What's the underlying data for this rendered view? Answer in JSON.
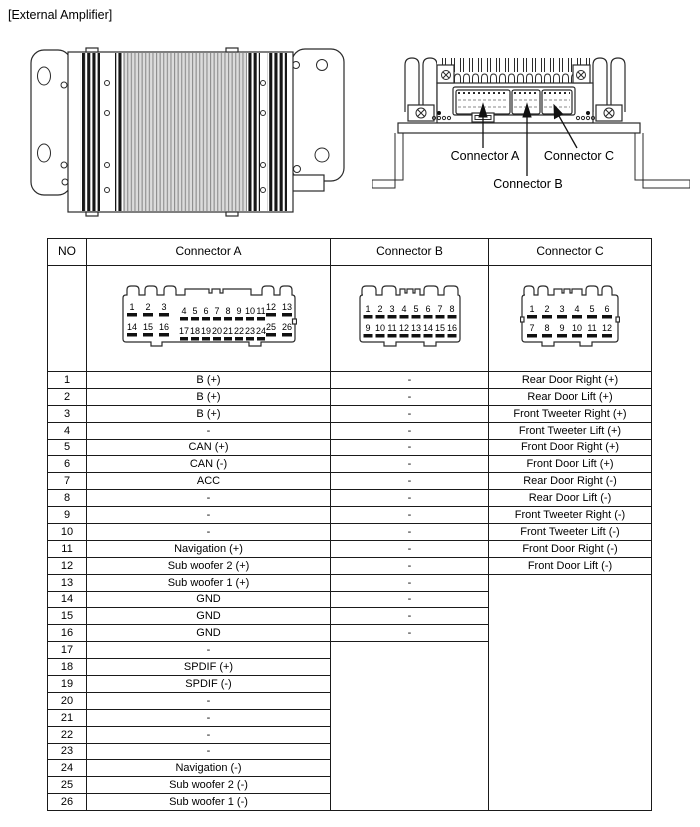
{
  "page": {
    "title": "[External Amplifier]"
  },
  "figures": {
    "rear_view": {
      "labels": {
        "connector_a": "Connector A",
        "connector_b": "Connector B",
        "connector_c": "Connector C"
      }
    }
  },
  "table": {
    "headers": [
      "NO",
      "Connector A",
      "Connector B",
      "Connector C"
    ],
    "pin_diagrams": {
      "a": {
        "top_left": [
          "1",
          "2",
          "3"
        ],
        "top_mid": [
          "4",
          "5",
          "6",
          "7",
          "8",
          "9",
          "10",
          "11"
        ],
        "top_right": [
          "12",
          "13"
        ],
        "bot_left": [
          "14",
          "15",
          "16"
        ],
        "bot_mid": [
          "17",
          "18",
          "19",
          "20",
          "21",
          "22",
          "23",
          "24"
        ],
        "bot_right": [
          "25",
          "26"
        ]
      },
      "b": {
        "top": [
          "1",
          "2",
          "3",
          "4",
          "5",
          "6",
          "7",
          "8"
        ],
        "bot": [
          "9",
          "10",
          "11",
          "12",
          "13",
          "14",
          "15",
          "16"
        ]
      },
      "c": {
        "top": [
          "1",
          "2",
          "3",
          "4",
          "5",
          "6"
        ],
        "bot": [
          "7",
          "8",
          "9",
          "10",
          "11",
          "12"
        ]
      }
    },
    "rows": [
      [
        "1",
        "B (+)",
        "-",
        "Rear Door Right (+)"
      ],
      [
        "2",
        "B (+)",
        "-",
        "Rear Door Lift (+)"
      ],
      [
        "3",
        "B (+)",
        "-",
        "Front Tweeter Right (+)"
      ],
      [
        "4",
        "-",
        "-",
        "Front Tweeter Lift (+)"
      ],
      [
        "5",
        "CAN (+)",
        "-",
        "Front Door Right (+)"
      ],
      [
        "6",
        "CAN (-)",
        "-",
        "Front Door Lift (+)"
      ],
      [
        "7",
        "ACC",
        "-",
        "Rear Door Right (-)"
      ],
      [
        "8",
        "-",
        "-",
        "Rear Door Lift (-)"
      ],
      [
        "9",
        "-",
        "-",
        "Front Tweeter Right (-)"
      ],
      [
        "10",
        "-",
        "-",
        "Front Tweeter Lift (-)"
      ],
      [
        "11",
        "Navigation (+)",
        "-",
        "Front Door Right (-)"
      ],
      [
        "12",
        "Sub woofer 2 (+)",
        "-",
        "Front Door Lift (-)"
      ],
      [
        "13",
        "Sub woofer 1 (+)",
        "-",
        ""
      ],
      [
        "14",
        "GND",
        "-"
      ],
      [
        "15",
        "GND",
        "-"
      ],
      [
        "16",
        "GND",
        "-"
      ],
      [
        "17",
        "-",
        ""
      ],
      [
        "18",
        "SPDIF (+)"
      ],
      [
        "19",
        "SPDIF (-)"
      ],
      [
        "20",
        "-"
      ],
      [
        "21",
        "-"
      ],
      [
        "22",
        "-"
      ],
      [
        "23",
        "-"
      ],
      [
        "24",
        "Navigation (-)"
      ],
      [
        "25",
        "Sub woofer 2 (-)"
      ],
      [
        "26",
        "Sub woofer 1 (-)"
      ]
    ],
    "merges": [
      {
        "col": 3,
        "row": 13,
        "span": 14
      },
      {
        "col": 2,
        "row": 17,
        "span": 10
      }
    ]
  }
}
